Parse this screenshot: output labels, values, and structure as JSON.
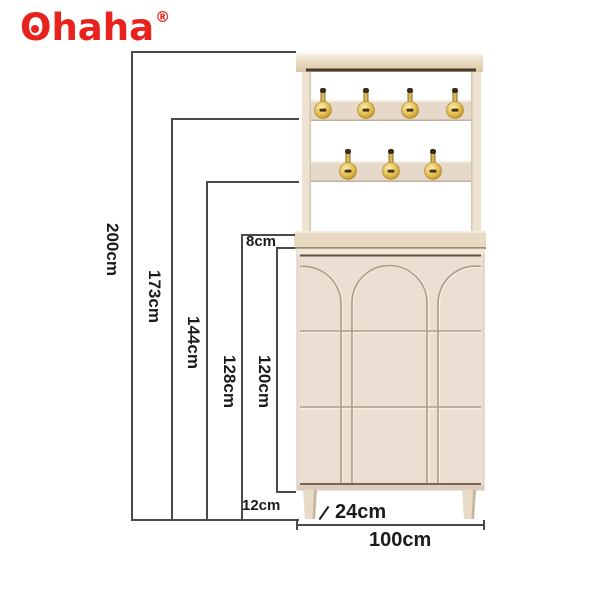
{
  "brand": {
    "name": "Ohaha",
    "registered_mark": "®",
    "color": "#e8231e"
  },
  "annotations": {
    "heights": [
      "200cm",
      "173cm",
      "144cm",
      "128cm",
      "120cm"
    ],
    "shelf_thickness": "8cm",
    "leg_height": "12cm",
    "depth": "24cm",
    "width": "100cm"
  },
  "furniture": {
    "description": "hall coat rack with two hook rails over arched-front shoe cabinet",
    "hook_row_top_count": 4,
    "hook_row_bottom_count": 3
  },
  "colors": {
    "dimension_line": "#4a4a4a",
    "label_text": "#1b1b1b",
    "cabinet_face": "#ebdfd4",
    "cabinet_top_strip": "#f1e8dc",
    "cabinet_dark_line": "#5f4e3f",
    "groove": "#b29b84",
    "rail": "#e6d9c9",
    "post": "#eee3d3",
    "shelf_board": "#e8dac2",
    "top_board_dark_line": "#4a3b2d",
    "hook_gold_dark": "#c89a2e",
    "leg": "#e7dac7",
    "background": "#ffffff"
  }
}
